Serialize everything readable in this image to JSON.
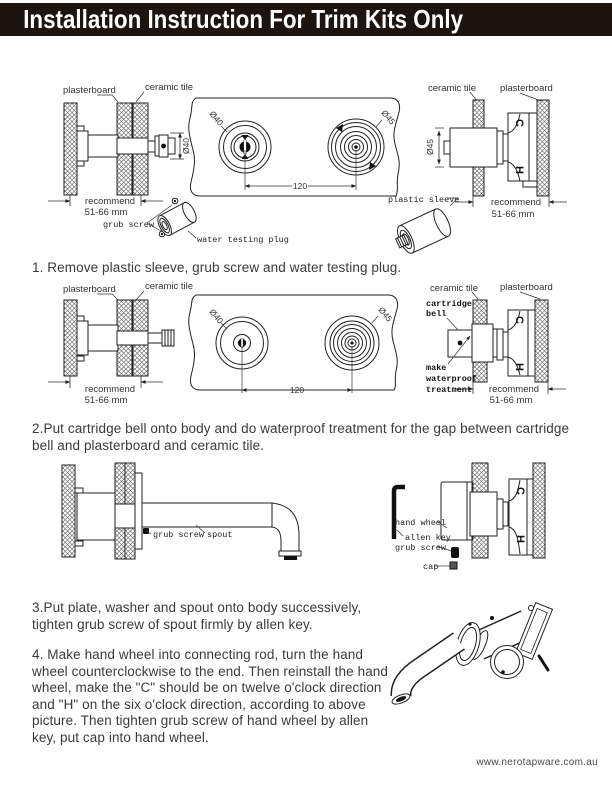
{
  "header": {
    "title": "Installation Instruction For Trim Kits Only"
  },
  "labels": {
    "plasterboard": "plasterboard",
    "ceramic_tile": "ceramic tile",
    "recommend": "recommend",
    "range_mm": "51-66 mm",
    "grub_screw": "grub screw",
    "water_testing_plug": "water testing plug",
    "plastic_sleeve": "plastic sleeve",
    "cartridge_bell_line1": "cartridge",
    "cartridge_bell_line2": "bell",
    "waterproof_line1": "make",
    "waterproof_line2": "waterproof",
    "waterproof_line3": "treatment",
    "hand_wheel": "hand wheel",
    "allen_key": "allen key",
    "cap": "cap",
    "spout": "spout",
    "dia_40": "Ø40",
    "dia_45": "Ø45",
    "dim_120": "120",
    "mark_c": "C",
    "mark_h": "H"
  },
  "steps": {
    "step1": "1. Remove plastic sleeve, grub screw and water testing plug.",
    "step2": "2.Put cartridge bell onto body and do waterproof treatment for the gap between cartridge bell and plasterboard and ceramic tile.",
    "step3": "3.Put plate, washer and spout onto body successively, tighten grub screw of spout firmly by allen key.",
    "step4": "4. Make hand wheel into connecting rod, turn the hand wheel counterclockwise to the end. Then reinstall the hand wheel, make the \"C\" should be on twelve o'clock direction and \"H\" on the six o'clock direction, according to above picture. Then tighten grub screw of hand wheel by allen key, put cap into hand wheel.",
    "recommend_range": "51-66 mm",
    "spacing_dim": "120",
    "hole_dia_left": "Ø40",
    "hole_dia_right": "Ø45"
  },
  "footer": {
    "website": "www.nerotapware.com.au"
  },
  "colors": {
    "header_bg": "#1d1410",
    "header_text": "#ffffff",
    "body_text": "#3b3b3b",
    "line_art": "#222222"
  }
}
